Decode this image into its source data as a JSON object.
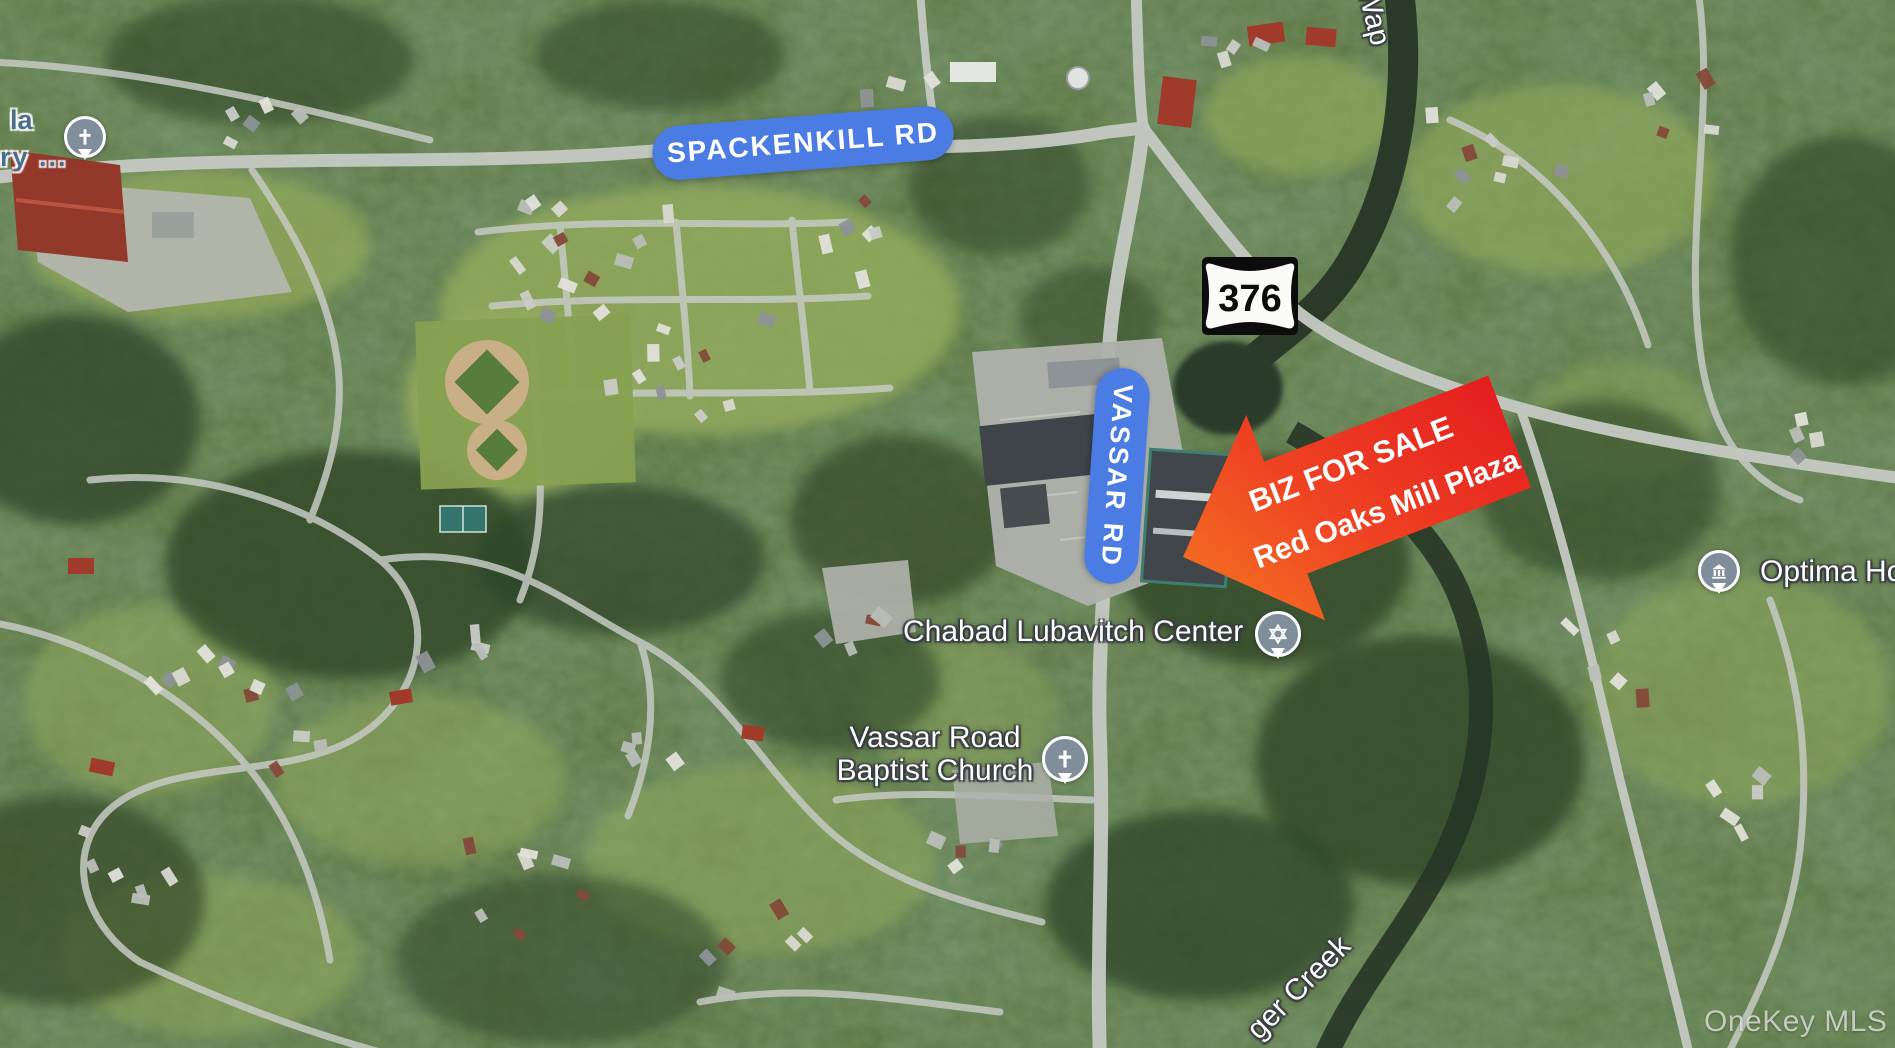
{
  "map": {
    "road_labels": {
      "spackenkill": "SPACKENKILL RD",
      "vassar": "VASSAR RD"
    },
    "route_shield": {
      "number": "376"
    },
    "sale_arrow": {
      "line1": "BIZ FOR SALE",
      "line2": "Red Oaks Mill Plaza"
    },
    "pois": {
      "chabad": {
        "name": "Chabad Lubavitch Center",
        "icon": "star-of-david-marker"
      },
      "baptist_church": {
        "line1": "Vassar Road",
        "line2": "Baptist Church",
        "icon": "cross-marker"
      },
      "optima": {
        "name": "Optima Hor",
        "icon": "building-marker"
      },
      "top_left_partial": {
        "line1": "la",
        "line2": "ry ...",
        "icon": "cross-marker"
      }
    },
    "creek_labels": {
      "top": "Wap",
      "bottom": "ger Creek"
    },
    "watermark": "OneKey MLS",
    "colors": {
      "road_pill_blue": "#4b7ce4",
      "arrow_red": "#e2181f",
      "arrow_orange": "#f47a20",
      "marker_slate": "#7f8e9a",
      "partial_label_blue": "#4a6e8c"
    }
  }
}
